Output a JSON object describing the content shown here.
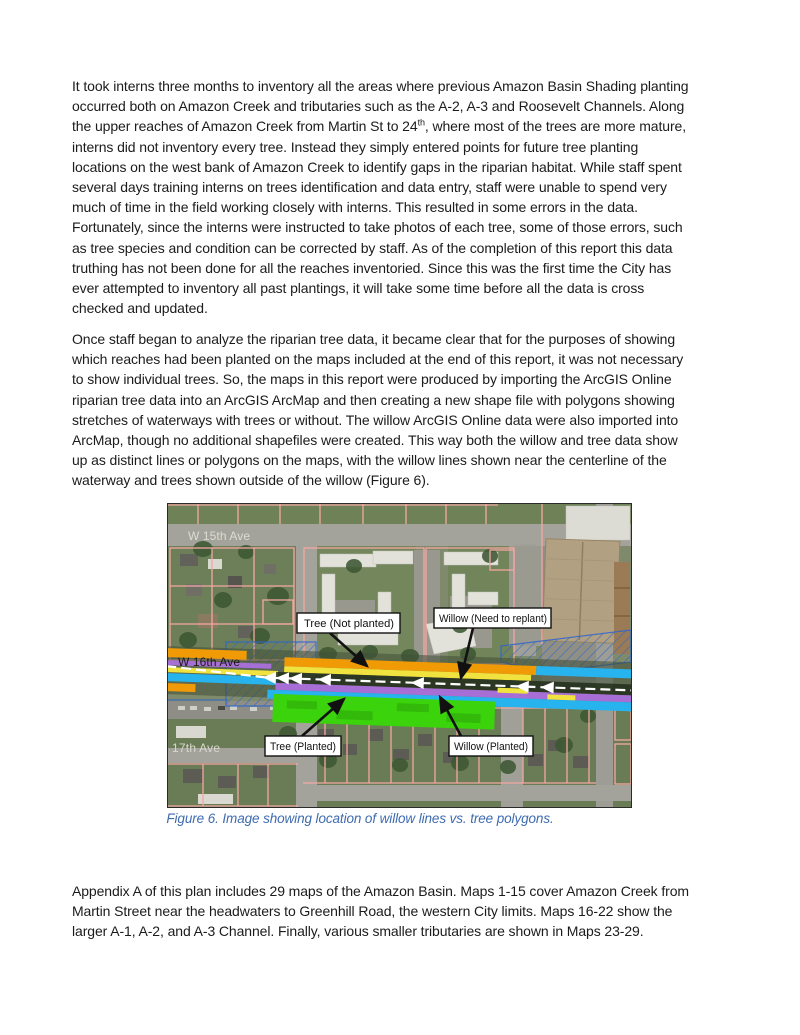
{
  "document": {
    "paragraphs": [
      {
        "name": "paragraph-1",
        "lines": [
          "It took interns three months to inventory all the areas where previous Amazon Basin Shading planting",
          "occurred both on Amazon Creek and tributaries such as the A-2, A-3 and Roosevelt Channels. Along",
          {
            "before": "the upper reaches of Amazon Creek from Martin St to 24",
            "sup": "th",
            "after": ", where most of the trees are more mature,"
          },
          "interns did not inventory every tree. Instead they simply entered points for future tree planting",
          "locations on the west bank of Amazon Creek to identify gaps in the riparian habitat. While staff spent",
          "several days training interns on trees identification and data entry, staff were unable to spend very",
          "much of time in the field working closely with interns. This resulted in some errors in the data.",
          "Fortunately, since the interns were instructed to take photos of each tree, some of those errors, such",
          "as tree species and condition can be corrected by staff. As of the completion of this report this data",
          "truthing has not been done for all the reaches inventoried. Since this was the first time the City has",
          "ever attempted to inventory all past plantings, it will take some time before all the data is cross",
          "checked and updated."
        ]
      },
      {
        "name": "paragraph-2",
        "lines": [
          "Once staff began to analyze the riparian tree data, it became clear that for the purposes of showing",
          "which reaches had been planted on the maps included at the end of this report, it was not necessary",
          "to show individual trees. So, the maps in this report were produced by importing the ArcGIS Online",
          "riparian tree data into an ArcGIS ArcMap and then creating a new shape file with polygons showing",
          "stretches of waterways with trees or without. The willow ArcGIS Online data were also imported into",
          "ArcMap, though no additional shapefiles were created. This way both the willow and tree data show",
          "up as distinct lines or polygons on the maps, with the willow lines shown near the centerline of the",
          "waterway and trees shown outside of the willow (Figure 6)."
        ]
      },
      {
        "name": "paragraph-3",
        "lines": [
          "Appendix A of this plan includes 29 maps of the Amazon Basin. Maps 1-15 cover Amazon Creek from",
          "Martin Street near the headwaters to Greenhill Road, the western City limits. Maps 16-22 show the",
          "larger A-1, A-2, and A-3 Channel. Finally, various smaller tributaries are shown in Maps 23-29."
        ]
      }
    ],
    "figure": {
      "caption": "Figure 6. Image showing location of willow lines vs. tree polygons.",
      "map": {
        "street_labels": [
          "W 15th Ave",
          "W 16th Ave",
          "17th Ave"
        ],
        "callouts": [
          "Tree (Not planted)",
          "Willow (Need to replant)",
          "Tree (Planted)",
          "Willow (Planted)"
        ],
        "colors": {
          "caption_blue": "#3E6BB0",
          "parcel_pink": "#F4A7A2",
          "willow_replant_orange": "#F09B06",
          "willow_line_yellow": "#F0E23F",
          "willow_line_purple": "#A76FD6",
          "tree_line_cyan": "#27B4EE",
          "tree_planted_green": "#3BD30C",
          "hatch_blue": "#2E66CC"
        }
      }
    }
  }
}
